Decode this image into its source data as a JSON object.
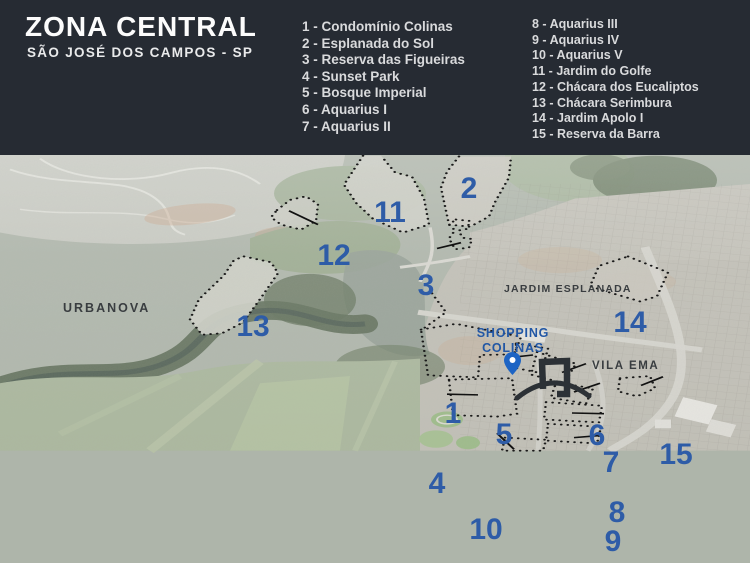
{
  "header": {
    "title": "ZONA CENTRAL",
    "subtitle": "SÃO JOSÉ DOS CAMPOS - SP"
  },
  "legend": {
    "column1": [
      "1 - Condomínio Colinas",
      "2 - Esplanada do Sol",
      "3 - Reserva das Figueiras",
      "4 - Sunset Park",
      "5 - Bosque Imperial",
      "6 - Aquarius I",
      "7 - Aquarius II"
    ],
    "column2": [
      "8 - Aquarius III",
      "9 - Aquarius IV",
      "10 - Aquarius V",
      "11 - Jardim do Golfe",
      "12 - Chácara dos Eucaliptos",
      "13 - Chácara Serimbura",
      "14 - Jardim Apolo I",
      "15 - Reserva da Barra"
    ]
  },
  "map": {
    "markers": [
      "1",
      "2",
      "3",
      "4",
      "5",
      "6",
      "7",
      "8",
      "9",
      "10",
      "11",
      "12",
      "13",
      "14",
      "15"
    ],
    "labels": {
      "urbanova": "URBANOVA",
      "jardim_esplanada": "JARDIM ESPLANADA",
      "vila_ema": "VILA EMA",
      "shopping_line1": "SHOPPING",
      "shopping_line2": "COLINAS"
    },
    "icons": {
      "pin": "location-pin",
      "arch": "colinas-arch-logo"
    },
    "colors": {
      "header_bg": "#262b33",
      "marker_blue": "#2e5ca7",
      "shopping_blue": "#2257a5",
      "pin_blue": "#1d64c4",
      "label_dark": "#393d40"
    }
  }
}
